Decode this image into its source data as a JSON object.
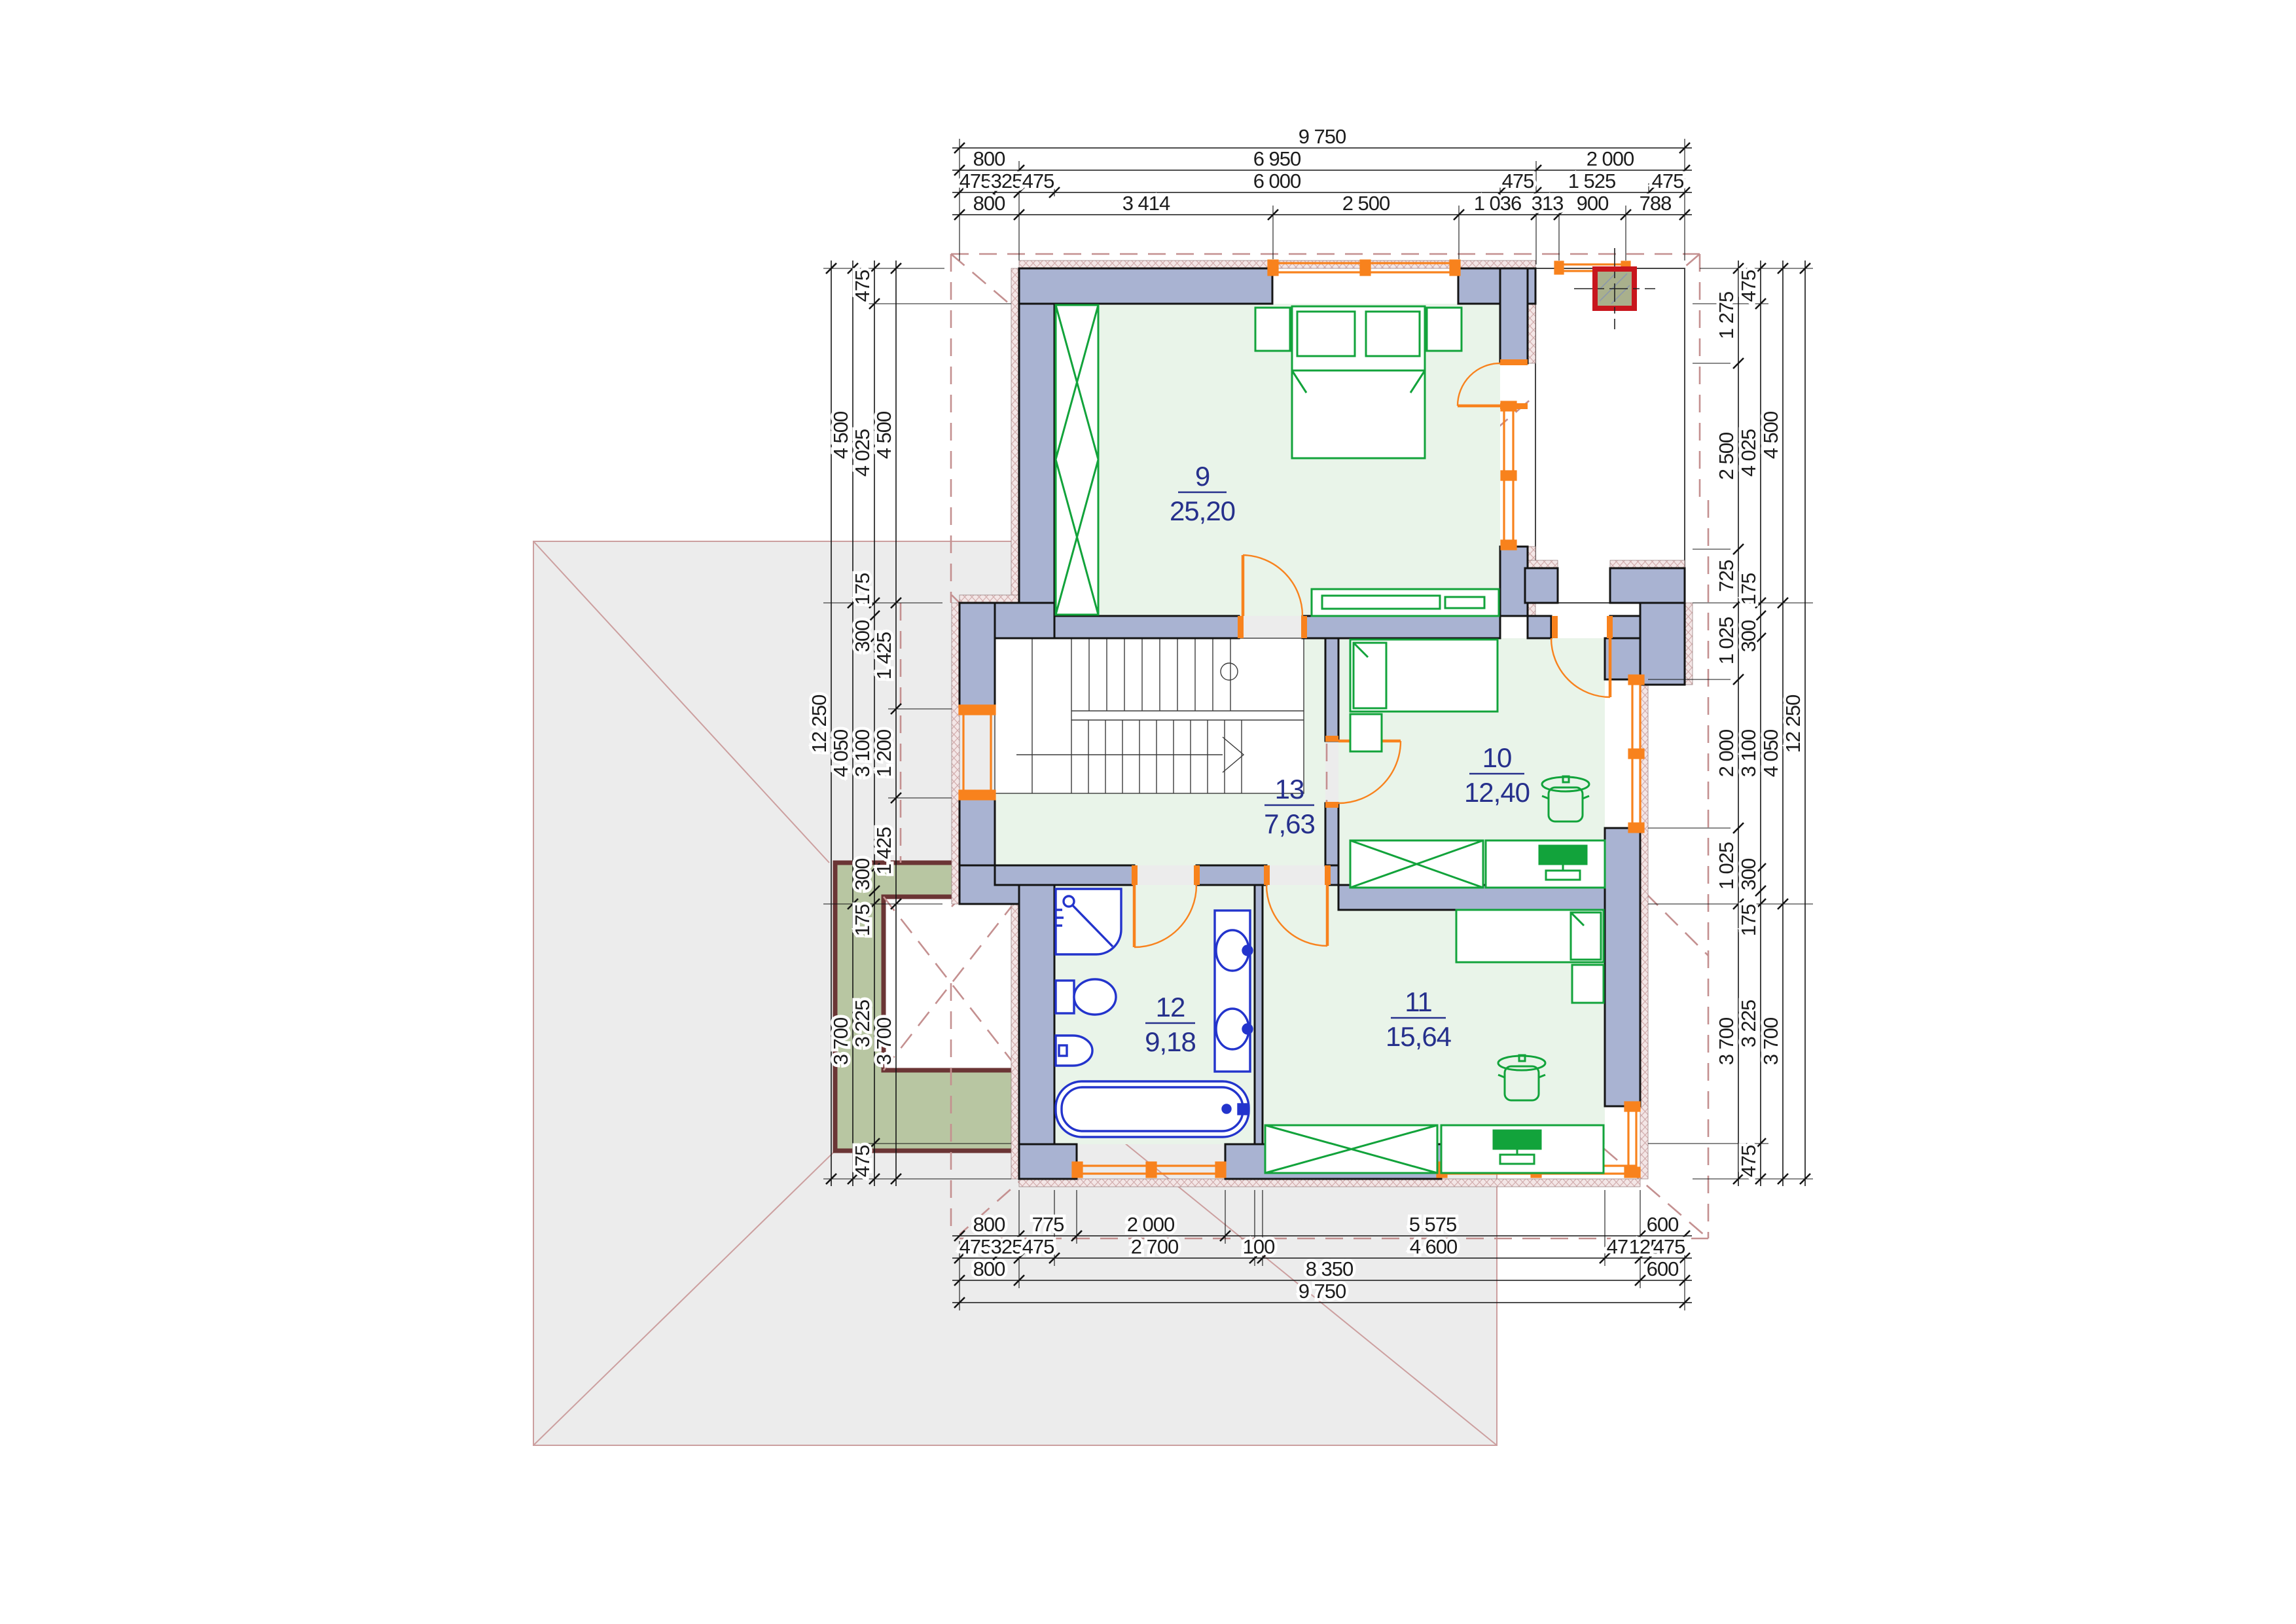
{
  "drawing": {
    "type": "floor-plan",
    "floor_label": "upper floor"
  },
  "rooms": [
    {
      "number": "9",
      "area": "25,20"
    },
    {
      "number": "10",
      "area": "12,40"
    },
    {
      "number": "11",
      "area": "15,64"
    },
    {
      "number": "12",
      "area": "9,18"
    },
    {
      "number": "13",
      "area": "7,63"
    }
  ],
  "dims": {
    "top": [
      "9 750",
      "800",
      "6 950",
      "2 000",
      "475",
      "325",
      "475",
      "6 000",
      "475",
      "1 525",
      "475",
      "800",
      "3 414",
      "2 500",
      "1 036",
      "313",
      "900",
      "788"
    ],
    "bottom": [
      "800",
      "775",
      "2 000",
      "5 575",
      "600",
      "475",
      "325",
      "475",
      "2 700",
      "100",
      "4 600",
      "475",
      "125",
      "475",
      "800",
      "8 350",
      "600",
      "9 750"
    ],
    "left": [
      "12 250",
      "4 500",
      "4 050",
      "3 700",
      "475",
      "4 025",
      "175",
      "300",
      "3 100",
      "300",
      "175",
      "3 225",
      "475",
      "4 500",
      "1 425",
      "1 200",
      "1 425",
      "3 700"
    ],
    "right": [
      "1 275",
      "2 500",
      "725",
      "1 025",
      "2 000",
      "1 025",
      "3 700",
      "475",
      "4 025",
      "175",
      "300",
      "3 100",
      "300",
      "175",
      "3 225",
      "475",
      "4 500",
      "4 050",
      "3 700",
      "12 250"
    ]
  },
  "colors": {
    "wall": "#a9b3d2",
    "wall_outline": "#141414",
    "room_floor": "#e9f4e9",
    "furniture": "#12a33b",
    "sanitary": "#2334cc",
    "window": "#f8821d",
    "roof_dash": "#c49090",
    "lower_roof": "#ececec",
    "terrace_fill": "#b8c6a2",
    "terrace_border": "#6b3535",
    "chimney_border": "#c8161d",
    "chimney_fill": "#a9b08c",
    "insulation": "#f3e6e6",
    "room_label": "#26308c"
  }
}
